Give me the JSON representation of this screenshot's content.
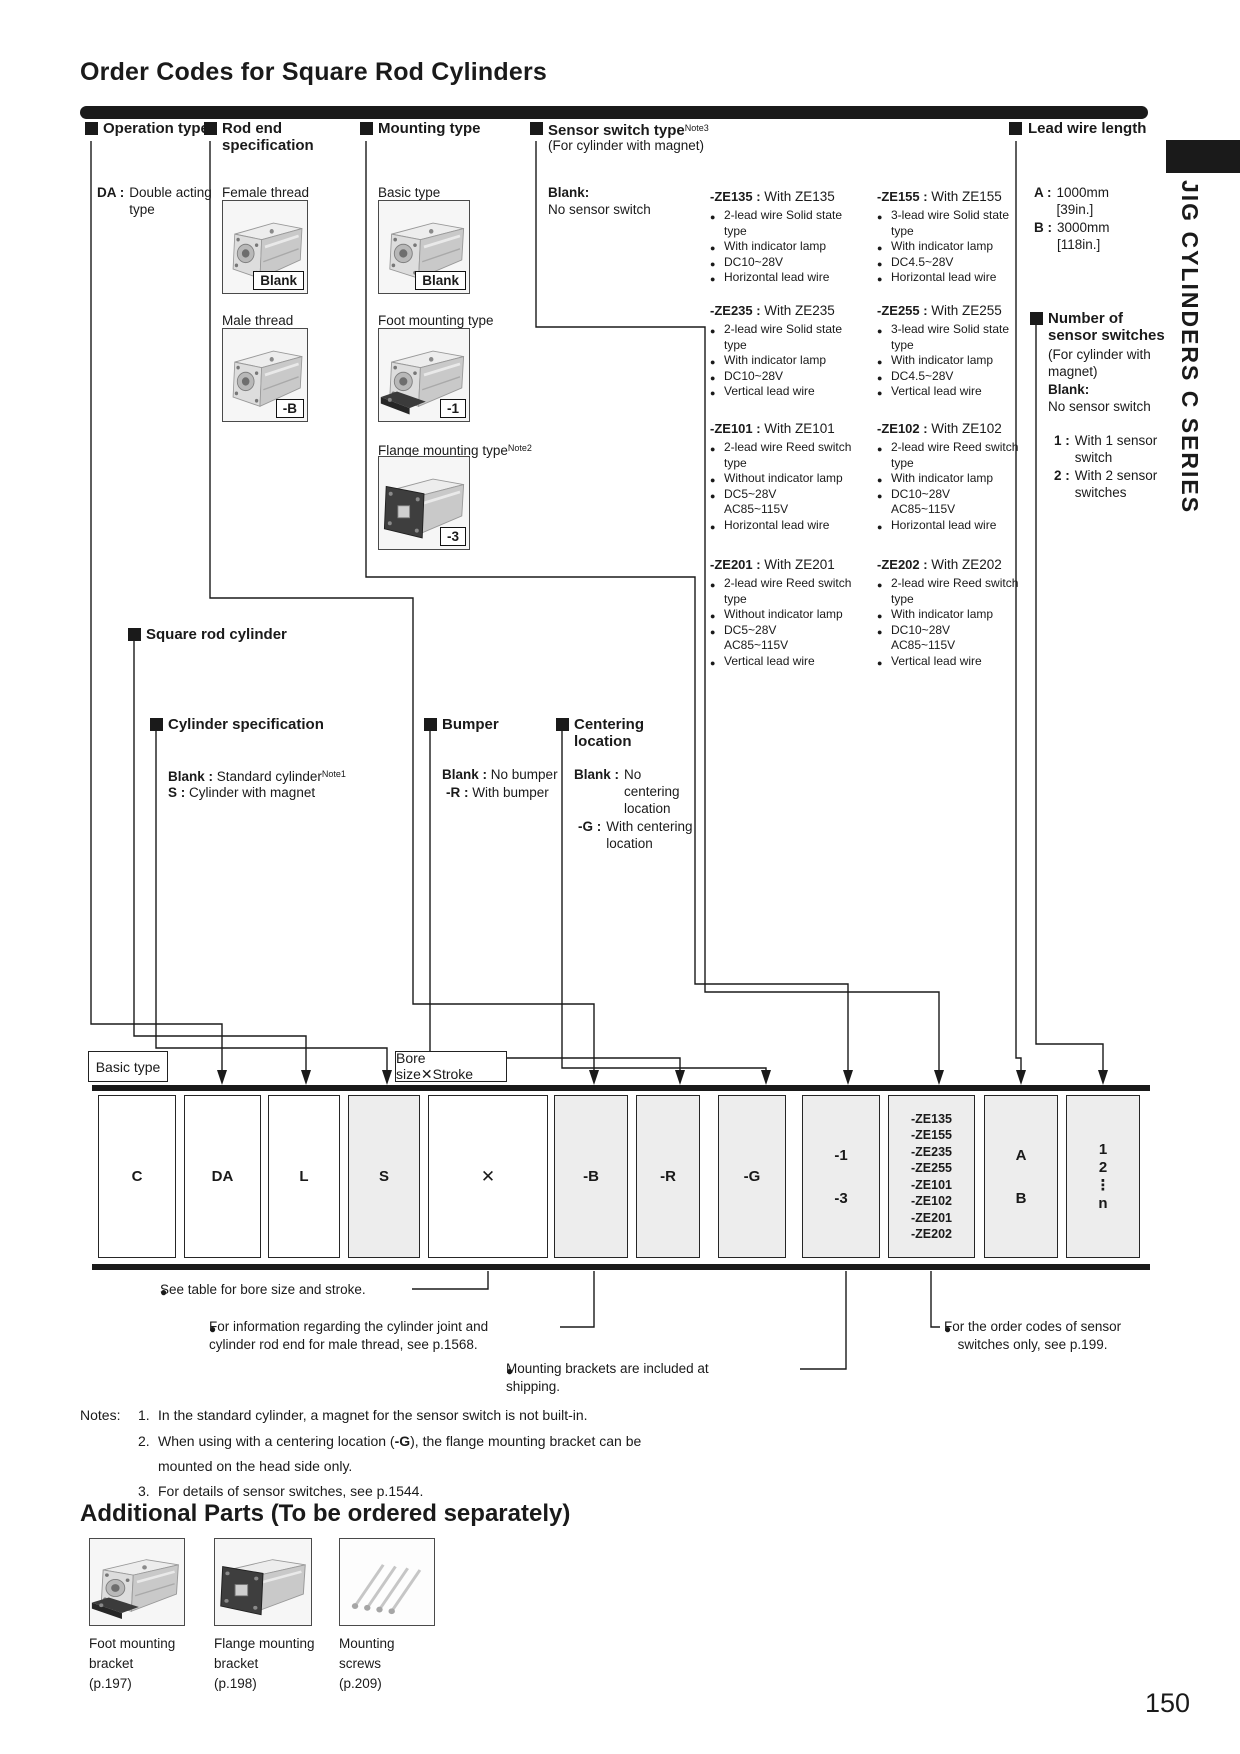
{
  "page": {
    "title": "Order Codes for Square Rod Cylinders",
    "side_tab_text": "JIG CYLINDERS C SERIES",
    "page_number": "150"
  },
  "icons": {
    "bullet": "●",
    "section_marker": "■"
  },
  "strings": {
    "sep": " : "
  },
  "operation": {
    "title": "Operation type",
    "da_code": "DA :",
    "da_desc": "Double acting type"
  },
  "rod_end": {
    "title": "Rod end specification",
    "female_label": "Female thread",
    "female_code": "Blank",
    "male_label": "Male thread",
    "male_code": "-B"
  },
  "mounting": {
    "title": "Mounting type",
    "basic_label": "Basic type",
    "basic_code": "Blank",
    "foot_label": "Foot mounting type",
    "foot_code": "-1",
    "flange_label": "Flange mounting type",
    "flange_note": "Note2",
    "flange_code": "-3"
  },
  "sensor": {
    "title": "Sensor switch type",
    "title_note": "Note3",
    "subtitle": "(For cylinder with magnet)",
    "blank_label": "Blank:",
    "blank_desc": "No sensor switch",
    "ze135": {
      "code": "-ZE135",
      "name": "With ZE135",
      "l1": "2-lead wire Solid state",
      "l1b": "type",
      "l2": "With indicator lamp",
      "l3": "DC10~28V",
      "l3b": "",
      "l4": "Horizontal lead wire"
    },
    "ze235": {
      "code": "-ZE235",
      "name": "With ZE235",
      "l1": "2-lead wire Solid state",
      "l1b": "type",
      "l2": "With indicator lamp",
      "l3": "DC10~28V",
      "l3b": "",
      "l4": "Vertical lead wire"
    },
    "ze101": {
      "code": "-ZE101",
      "name": "With ZE101",
      "l1": "2-lead wire Reed switch",
      "l1b": "type",
      "l2": "Without indicator lamp",
      "l3": "DC5~28V",
      "l3b": "AC85~115V",
      "l4": "Horizontal lead wire"
    },
    "ze201": {
      "code": "-ZE201",
      "name": "With ZE201",
      "l1": "2-lead wire Reed switch",
      "l1b": "type",
      "l2": "Without indicator lamp",
      "l3": "DC5~28V",
      "l3b": "AC85~115V",
      "l4": "Vertical lead wire"
    },
    "ze155": {
      "code": "-ZE155",
      "name": "With ZE155",
      "l1": "3-lead wire Solid state",
      "l1b": "type",
      "l2": "With indicator lamp",
      "l3": "DC4.5~28V",
      "l3b": "",
      "l4": "Horizontal lead wire"
    },
    "ze255": {
      "code": "-ZE255",
      "name": "With ZE255",
      "l1": "3-lead wire Solid state",
      "l1b": "type",
      "l2": "With indicator lamp",
      "l3": "DC4.5~28V",
      "l3b": "",
      "l4": "Vertical lead wire"
    },
    "ze102": {
      "code": "-ZE102",
      "name": "With ZE102",
      "l1": "2-lead wire Reed switch",
      "l1b": "type",
      "l2": "With indicator lamp",
      "l3": "DC10~28V",
      "l3b": "AC85~115V",
      "l4": "Horizontal lead wire"
    },
    "ze202": {
      "code": "-ZE202",
      "name": "With ZE202",
      "l1": "2-lead wire Reed switch",
      "l1b": "type",
      "l2": "With indicator lamp",
      "l3": "DC10~28V",
      "l3b": "AC85~115V",
      "l4": "Vertical lead wire"
    }
  },
  "lead_wire": {
    "title": "Lead wire length",
    "a_code": "A :",
    "a_val": "1000mm",
    "a_inch": "[39in.]",
    "b_code": "B :",
    "b_val": "3000mm",
    "b_inch": "[118in.]"
  },
  "num_switches": {
    "title": "Number of sensor switches",
    "subtitle": "(For cylinder with magnet)",
    "blank_label": "Blank:",
    "blank_desc": "No sensor switch",
    "one_code": "1 :",
    "one_desc": "With 1 sensor switch",
    "two_code": "2 :",
    "two_desc": "With 2 sensor switches"
  },
  "square_rod": {
    "title": "Square rod cylinder"
  },
  "cyl_spec": {
    "title": "Cylinder specification",
    "blank_label": "Blank :",
    "blank_desc": "Standard cylinder",
    "blank_note": "Note1",
    "s_label": "S :",
    "s_desc": "Cylinder with magnet"
  },
  "bumper": {
    "title": "Bumper",
    "blank_label": "Blank :",
    "blank_desc": "No bumper",
    "r_label": "-R :",
    "r_desc": "With bumper"
  },
  "centering": {
    "title": "Centering location",
    "blank_label": "Blank :",
    "blank_desc": "No centering location",
    "g_label": "-G :",
    "g_desc": "With centering location"
  },
  "order_row": {
    "basic_type_label": "Basic type",
    "bore_stroke_label": "Bore size✕Stroke",
    "cells": [
      {
        "lines": [
          "C"
        ]
      },
      {
        "lines": [
          "DA"
        ]
      },
      {
        "lines": [
          "L"
        ]
      },
      {
        "lines": [
          "S"
        ]
      },
      {
        "lines": [
          "✕"
        ]
      },
      {
        "lines": [
          "-B"
        ]
      },
      {
        "lines": [
          "-R"
        ]
      },
      {
        "lines": [
          "-G"
        ]
      },
      {
        "lines": [
          "-1",
          "-3"
        ]
      },
      {
        "lines": [
          "-ZE135",
          "-ZE155",
          "-ZE235",
          "-ZE255",
          "-ZE101",
          "-ZE102",
          "-ZE201",
          "-ZE202"
        ]
      },
      {
        "lines": [
          "A",
          "B"
        ]
      },
      {
        "lines": [
          "1",
          "2",
          "⋮",
          "n"
        ]
      }
    ]
  },
  "callouts": {
    "c1": "See table for bore size and stroke.",
    "c2a": "For information regarding the cylinder joint and",
    "c2b": "cylinder rod end for male thread, see p.1568.",
    "c3a": "Mounting brackets are included at",
    "c3b": "shipping.",
    "c4a": "For the order codes of sensor",
    "c4b": "switches only, see p.199."
  },
  "notes": {
    "label": "Notes:",
    "n1_num": "1.",
    "n1": "In the standard cylinder, a magnet for the sensor switch is not built-in.",
    "n2_num": "2.",
    "n2_pre": "When using with a centering location (",
    "n2_bold": "-G",
    "n2_post": "), the flange mounting bracket can be",
    "n2b": "mounted on the head side only.",
    "n3_num": "3.",
    "n3": "For details of sensor switches, see p.1544."
  },
  "additional": {
    "title": "Additional Parts (To be ordered separately)",
    "parts": [
      {
        "name": "Foot mounting bracket",
        "page": "(p.197)"
      },
      {
        "name": "Flange mounting bracket",
        "page": "(p.198)"
      },
      {
        "name": "Mounting screws",
        "page": "(p.209)"
      }
    ]
  }
}
